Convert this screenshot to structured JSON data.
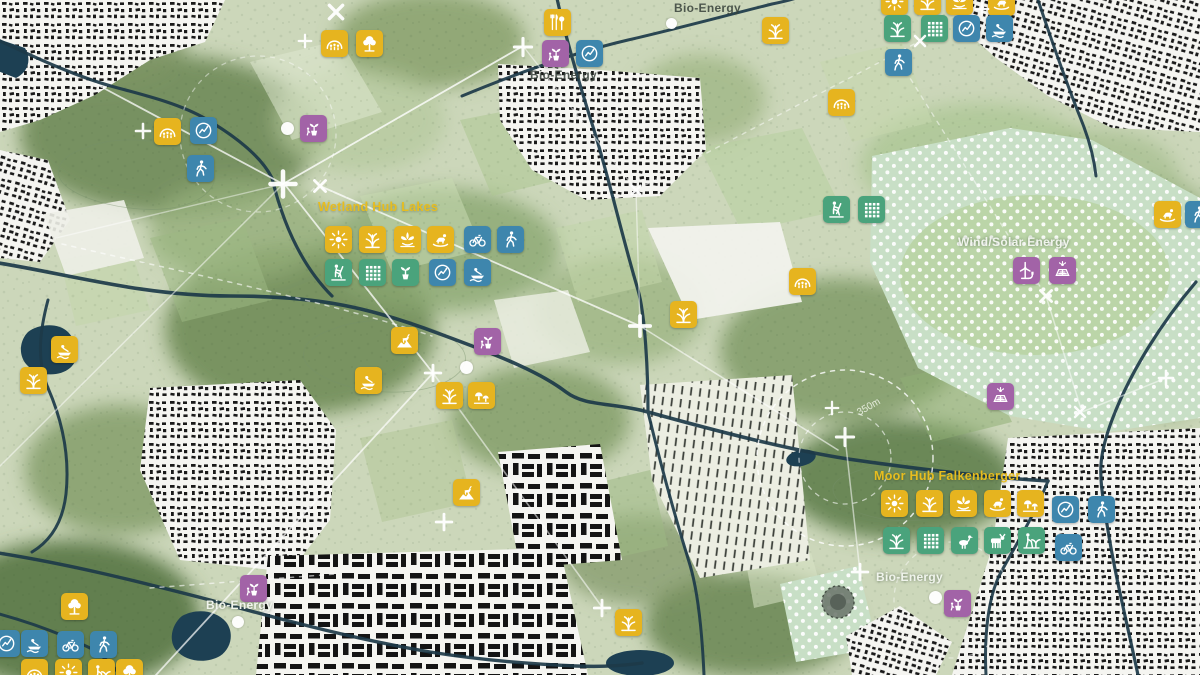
{
  "map": {
    "icon_size": 27,
    "icon_colors": {
      "yellow": "#e6b41f",
      "green": "#4aa37c",
      "blue": "#3e86ad",
      "purple": "#a263a7"
    },
    "map_colors": {
      "base_field": "#ccd7ba",
      "forest": "#6f8a58",
      "river": "#1d3a49",
      "water": "#1d4053",
      "urban": "#f5f5f1",
      "polka_field": "#c8dfc6",
      "marker": "#ffffff"
    },
    "region_labels": [
      {
        "text": "Bio-Energy",
        "x": 674,
        "y": 1,
        "style": "dark"
      },
      {
        "text": "Bio-Energy",
        "x": 530,
        "y": 68,
        "style": "dark"
      },
      {
        "text": "Bio-Energy",
        "x": 876,
        "y": 570,
        "style": "light"
      },
      {
        "text": "Bio-Energy",
        "x": 206,
        "y": 598,
        "style": "light"
      },
      {
        "text": "Wind/Solar Energy",
        "x": 958,
        "y": 235,
        "style": "light"
      },
      {
        "text": "Wetland Hub Lakes",
        "x": 318,
        "y": 200,
        "style": "yellow"
      },
      {
        "text": "Moor Hub Falkenberger",
        "x": 874,
        "y": 469,
        "style": "yellow"
      },
      {
        "text": "350m",
        "x": 858,
        "y": 408,
        "style": "radius",
        "rotate": -30
      }
    ],
    "icons": [
      {
        "x": 334,
        "y": 43,
        "c": "yellow",
        "g": "shelter"
      },
      {
        "x": 369,
        "y": 43,
        "c": "yellow",
        "g": "tree"
      },
      {
        "x": 557,
        "y": 22,
        "c": "yellow",
        "g": "picnic"
      },
      {
        "x": 555,
        "y": 53,
        "c": "purple",
        "g": "nursery"
      },
      {
        "x": 589,
        "y": 53,
        "c": "blue",
        "g": "compass"
      },
      {
        "x": 167,
        "y": 131,
        "c": "yellow",
        "g": "shelter"
      },
      {
        "x": 203,
        "y": 130,
        "c": "blue",
        "g": "compass"
      },
      {
        "x": 200,
        "y": 168,
        "c": "blue",
        "g": "walk"
      },
      {
        "x": 313,
        "y": 128,
        "c": "purple",
        "g": "nursery"
      },
      {
        "x": 775,
        "y": 30,
        "c": "yellow",
        "g": "reeds"
      },
      {
        "x": 894,
        "y": 1,
        "c": "yellow",
        "g": "sun"
      },
      {
        "x": 927,
        "y": 1,
        "c": "yellow",
        "g": "reeds"
      },
      {
        "x": 959,
        "y": 1,
        "c": "yellow",
        "g": "lotus"
      },
      {
        "x": 1001,
        "y": 2,
        "c": "yellow",
        "g": "play"
      },
      {
        "x": 897,
        "y": 28,
        "c": "green",
        "g": "reeds"
      },
      {
        "x": 934,
        "y": 28,
        "c": "green",
        "g": "grid"
      },
      {
        "x": 966,
        "y": 28,
        "c": "blue",
        "g": "compass"
      },
      {
        "x": 999,
        "y": 28,
        "c": "blue",
        "g": "boat"
      },
      {
        "x": 898,
        "y": 62,
        "c": "blue",
        "g": "walk"
      },
      {
        "x": 841,
        "y": 102,
        "c": "yellow",
        "g": "shelter"
      },
      {
        "x": 836,
        "y": 209,
        "c": "green",
        "g": "farmer"
      },
      {
        "x": 871,
        "y": 209,
        "c": "green",
        "g": "grid"
      },
      {
        "x": 802,
        "y": 281,
        "c": "yellow",
        "g": "shelter"
      },
      {
        "x": 1167,
        "y": 214,
        "c": "yellow",
        "g": "play"
      },
      {
        "x": 1198,
        "y": 214,
        "c": "blue",
        "g": "walk"
      },
      {
        "x": 1026,
        "y": 270,
        "c": "purple",
        "g": "turbine"
      },
      {
        "x": 1062,
        "y": 270,
        "c": "purple",
        "g": "solar"
      },
      {
        "x": 1000,
        "y": 396,
        "c": "purple",
        "g": "solar"
      },
      {
        "x": 338,
        "y": 239,
        "c": "yellow",
        "g": "sun"
      },
      {
        "x": 372,
        "y": 239,
        "c": "yellow",
        "g": "reeds"
      },
      {
        "x": 407,
        "y": 239,
        "c": "yellow",
        "g": "lotus"
      },
      {
        "x": 440,
        "y": 239,
        "c": "yellow",
        "g": "play"
      },
      {
        "x": 477,
        "y": 239,
        "c": "blue",
        "g": "bike"
      },
      {
        "x": 510,
        "y": 239,
        "c": "blue",
        "g": "walk"
      },
      {
        "x": 338,
        "y": 272,
        "c": "green",
        "g": "farmer"
      },
      {
        "x": 372,
        "y": 272,
        "c": "green",
        "g": "grid"
      },
      {
        "x": 405,
        "y": 272,
        "c": "green",
        "g": "sprout"
      },
      {
        "x": 442,
        "y": 272,
        "c": "blue",
        "g": "compass"
      },
      {
        "x": 477,
        "y": 272,
        "c": "blue",
        "g": "boat"
      },
      {
        "x": 404,
        "y": 340,
        "c": "yellow",
        "g": "goat"
      },
      {
        "x": 487,
        "y": 341,
        "c": "purple",
        "g": "nursery"
      },
      {
        "x": 368,
        "y": 380,
        "c": "yellow",
        "g": "boat"
      },
      {
        "x": 449,
        "y": 395,
        "c": "yellow",
        "g": "reeds"
      },
      {
        "x": 481,
        "y": 395,
        "c": "yellow",
        "g": "forage"
      },
      {
        "x": 683,
        "y": 314,
        "c": "yellow",
        "g": "reeds"
      },
      {
        "x": 64,
        "y": 349,
        "c": "yellow",
        "g": "boat"
      },
      {
        "x": 33,
        "y": 380,
        "c": "yellow",
        "g": "reeds"
      },
      {
        "x": 466,
        "y": 492,
        "c": "yellow",
        "g": "goat"
      },
      {
        "x": 894,
        "y": 503,
        "c": "yellow",
        "g": "sun"
      },
      {
        "x": 929,
        "y": 503,
        "c": "yellow",
        "g": "reeds"
      },
      {
        "x": 963,
        "y": 503,
        "c": "yellow",
        "g": "lotus"
      },
      {
        "x": 997,
        "y": 503,
        "c": "yellow",
        "g": "play"
      },
      {
        "x": 1030,
        "y": 503,
        "c": "yellow",
        "g": "forage"
      },
      {
        "x": 1065,
        "y": 509,
        "c": "blue",
        "g": "compass"
      },
      {
        "x": 1101,
        "y": 509,
        "c": "blue",
        "g": "walk"
      },
      {
        "x": 896,
        "y": 540,
        "c": "green",
        "g": "reeds"
      },
      {
        "x": 930,
        "y": 540,
        "c": "green",
        "g": "grid"
      },
      {
        "x": 964,
        "y": 540,
        "c": "green",
        "g": "goose"
      },
      {
        "x": 997,
        "y": 540,
        "c": "green",
        "g": "cow"
      },
      {
        "x": 1031,
        "y": 540,
        "c": "green",
        "g": "gardener"
      },
      {
        "x": 1068,
        "y": 547,
        "c": "blue",
        "g": "bike"
      },
      {
        "x": 957,
        "y": 603,
        "c": "purple",
        "g": "nursery"
      },
      {
        "x": 253,
        "y": 588,
        "c": "purple",
        "g": "nursery"
      },
      {
        "x": 628,
        "y": 622,
        "c": "yellow",
        "g": "reeds"
      },
      {
        "x": 74,
        "y": 606,
        "c": "yellow",
        "g": "tree"
      },
      {
        "x": 6,
        "y": 643,
        "c": "blue",
        "g": "compass"
      },
      {
        "x": 34,
        "y": 643,
        "c": "blue",
        "g": "boat"
      },
      {
        "x": 70,
        "y": 644,
        "c": "blue",
        "g": "bike"
      },
      {
        "x": 103,
        "y": 644,
        "c": "blue",
        "g": "walk"
      },
      {
        "x": 34,
        "y": 672,
        "c": "yellow",
        "g": "shelter"
      },
      {
        "x": 68,
        "y": 672,
        "c": "yellow",
        "g": "sun"
      },
      {
        "x": 101,
        "y": 672,
        "c": "yellow",
        "g": "gardener"
      },
      {
        "x": 129,
        "y": 672,
        "c": "yellow",
        "g": "tree"
      }
    ],
    "markers": [
      {
        "t": "plus",
        "x": 283,
        "y": 184,
        "s": 32
      },
      {
        "t": "cross",
        "x": 320,
        "y": 186,
        "s": 20
      },
      {
        "t": "cross",
        "x": 336,
        "y": 12,
        "s": 24
      },
      {
        "t": "plus",
        "x": 305,
        "y": 41,
        "s": 16
      },
      {
        "t": "plus",
        "x": 523,
        "y": 47,
        "s": 22
      },
      {
        "t": "plus",
        "x": 143,
        "y": 131,
        "s": 18
      },
      {
        "t": "plus",
        "x": 640,
        "y": 326,
        "s": 26
      },
      {
        "t": "plus",
        "x": 433,
        "y": 373,
        "s": 20
      },
      {
        "t": "plus",
        "x": 444,
        "y": 522,
        "s": 20
      },
      {
        "t": "plus",
        "x": 860,
        "y": 572,
        "s": 20
      },
      {
        "t": "plus",
        "x": 845,
        "y": 437,
        "s": 22
      },
      {
        "t": "plus",
        "x": 832,
        "y": 408,
        "s": 16
      },
      {
        "t": "cross",
        "x": 920,
        "y": 41,
        "s": 18
      },
      {
        "t": "cross",
        "x": 1046,
        "y": 296,
        "s": 20
      },
      {
        "t": "cross",
        "x": 1080,
        "y": 412,
        "s": 18
      },
      {
        "t": "plus",
        "x": 1166,
        "y": 378,
        "s": 18
      },
      {
        "t": "plus",
        "x": 602,
        "y": 608,
        "s": 20
      },
      {
        "t": "plus",
        "x": 982,
        "y": 9,
        "s": 16
      },
      {
        "t": "cross",
        "x": 636,
        "y": 190,
        "s": 16
      }
    ],
    "dots": [
      {
        "x": 287,
        "y": 128,
        "d": 13
      },
      {
        "x": 466,
        "y": 367,
        "d": 13
      },
      {
        "x": 935,
        "y": 597,
        "d": 13
      },
      {
        "x": 238,
        "y": 622,
        "d": 12
      },
      {
        "x": 671,
        "y": 23,
        "d": 11
      }
    ]
  }
}
